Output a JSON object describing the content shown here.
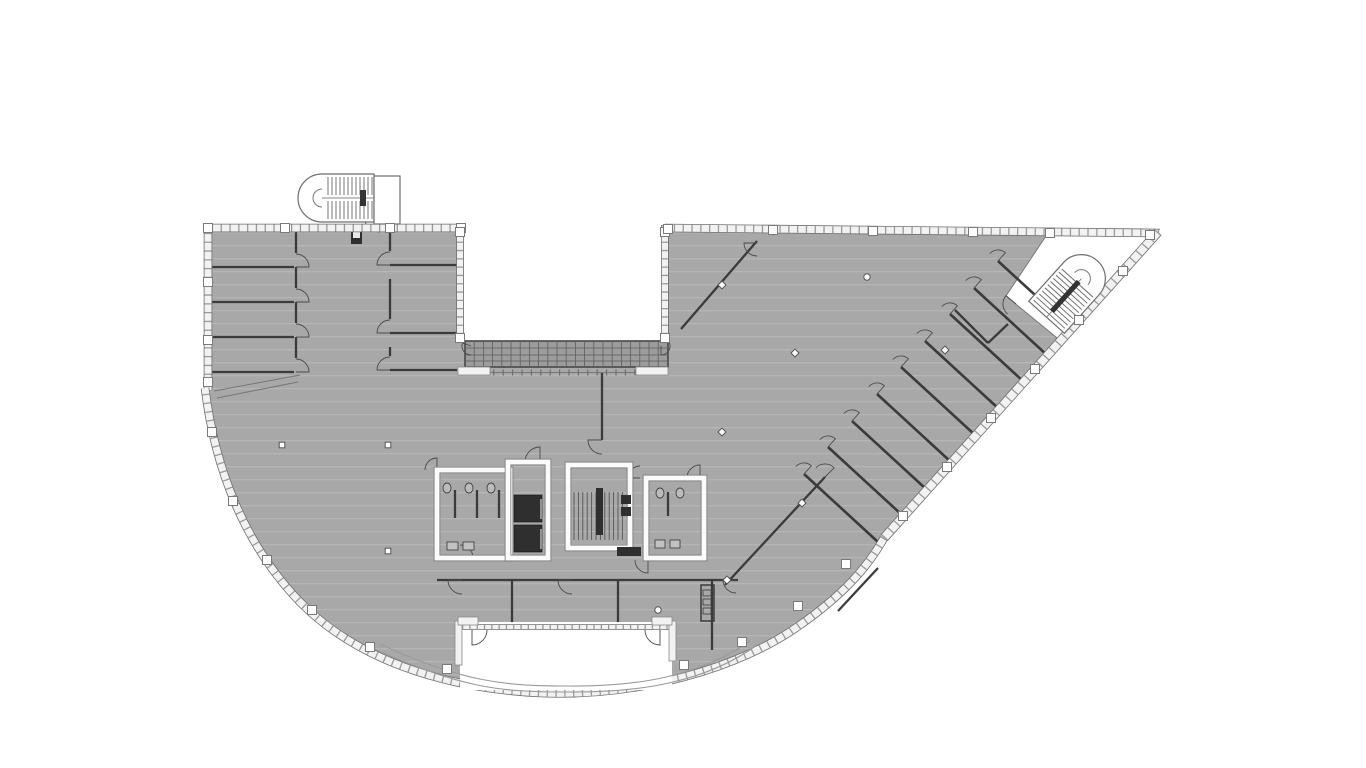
{
  "meta": {
    "description": "Grayscale architectural floor plan: fan-shaped office floor with curved south facade, rectangular north-west wing, diagonal north-east wing, two external U-stairs, central core with elevators, dog-leg stair and toilet blocks, glazed bridge over a void, terrace notch at the south facade",
    "canvas": {
      "width": 1366,
      "height": 768
    }
  },
  "palette": {
    "bg": "#ffffff",
    "floor": "#a8a8a8",
    "floor_stripe": "#bdbdbd",
    "wall_dark": "#3b3b3b",
    "outline": "#5a5a5a",
    "band_fill": "#f2f2f2",
    "band_edge": "#6e6e6e",
    "band_rung": "#9a9a9a",
    "bridge_fill": "#9c9c9c",
    "bridge_grid": "#5e5e5e",
    "elevator_dark": "#2f2f2f",
    "white": "#ffffff",
    "thin_line": "#777777"
  },
  "plan": {
    "plate": {
      "name": "floor-plate",
      "d": "M 205 225 L 463 225 L 463 341 L 668 341 L 668 225 L 1158 231 L 884 538 C 866 570 840 597 800 625 C 740 668 640 697 540 693 C 440 688 355 658 300 602 C 245 545 215 470 205 388 Z"
    },
    "pocket": {
      "name": "stair-pocket",
      "d": "M 1048 233 L 1148 233 L 1150 242 L 1062 342 L 1006 296 Z"
    },
    "notch": {
      "name": "terrace-notch",
      "d": "M 460 622 L 672 622 L 672 690 L 460 690 Z"
    },
    "canopy": [
      {
        "name": "canopy-arc-outer",
        "d": "M 372 648 C 460 688 500 692 566 692 C 640 693 706 682 757 645"
      },
      {
        "name": "canopy-arc-inner",
        "d": "M 380 644 C 462 682 505 686 566 686 C 638 687 700 676 750 641"
      }
    ],
    "bands": [
      {
        "name": "facade-top-left-wing",
        "d": "M 203 228 L 465 228",
        "w": 7,
        "gap": 7.5
      },
      {
        "name": "facade-left",
        "d": "M 208 224 L 208 390",
        "w": 7,
        "gap": 7.5
      },
      {
        "name": "facade-void-left",
        "d": "M 460 225 L 460 341",
        "w": 6,
        "gap": 7
      },
      {
        "name": "facade-void-right",
        "d": "M 665 225 L 665 341",
        "w": 6,
        "gap": 7
      },
      {
        "name": "facade-top-right-wing",
        "d": "M 665 228 L 1160 233",
        "w": 7,
        "gap": 7.5
      },
      {
        "name": "facade-diagonal",
        "d": "M 1158 232 L 884 538",
        "w": 8,
        "gap": 8
      },
      {
        "name": "facade-curve",
        "d": "M 884 538 C 866 570 840 597 800 625 C 740 668 640 697 540 693 C 440 688 355 658 300 602 C 245 545 215 470 205 388",
        "w": 7,
        "gap": 7.5
      }
    ],
    "notch_band": {
      "name": "terrace-glazing",
      "d": "M 462 627 L 670 627",
      "w": 4,
      "gap": 6
    },
    "notch_rects": [
      [
        455,
        621,
        7,
        44
      ],
      [
        669,
        621,
        7,
        40
      ],
      [
        458,
        617,
        20,
        8
      ],
      [
        652,
        617,
        20,
        8
      ]
    ],
    "notch_doors": [
      {
        "x": 472,
        "y": 630,
        "r": 15,
        "f": 0,
        "t": 90
      },
      {
        "x": 660,
        "y": 630,
        "r": 15,
        "f": 180,
        "t": 90
      }
    ],
    "bridge": {
      "name": "glazed-bridge",
      "x": 465,
      "y": 341,
      "w": 203,
      "h": 26,
      "vstep": 9.2,
      "hlines": [
        348,
        355,
        361
      ],
      "rail_y": 372.5,
      "sills": [
        [
          458,
          367,
          32,
          8
        ],
        [
          636,
          367,
          32,
          8
        ]
      ],
      "hooks": [
        {
          "x": 471,
          "y": 346,
          "r": 9,
          "f": 90,
          "t": 200
        },
        {
          "x": 661,
          "y": 346,
          "r": 9,
          "f": -20,
          "t": 90
        }
      ]
    },
    "walls": [
      [
        208,
        267,
        294,
        267
      ],
      [
        208,
        302,
        294,
        302
      ],
      [
        208,
        337,
        294,
        337
      ],
      [
        208,
        372,
        294,
        372
      ],
      [
        296,
        232,
        296,
        253
      ],
      [
        296,
        267,
        296,
        288
      ],
      [
        296,
        302,
        296,
        323
      ],
      [
        296,
        337,
        296,
        358
      ],
      [
        390,
        265,
        462,
        265
      ],
      [
        390,
        333,
        462,
        333
      ],
      [
        390,
        370,
        457,
        370
      ],
      [
        390,
        232,
        390,
        251
      ],
      [
        390,
        279,
        390,
        319
      ],
      [
        390,
        347,
        390,
        356
      ],
      [
        602,
        373,
        602,
        440
      ],
      [
        437,
        580,
        738,
        580
      ],
      [
        512,
        580,
        512,
        624
      ],
      [
        618,
        580,
        618,
        624
      ],
      [
        712,
        580,
        712,
        650
      ],
      [
        757,
        241,
        681,
        329
      ],
      [
        825,
        477,
        725,
        585
      ],
      [
        878,
        568,
        838,
        611
      ],
      [
        955,
        310,
        988,
        343
      ],
      [
        988,
        343,
        1008,
        324
      ],
      [
        455,
        490,
        455,
        518
      ],
      [
        477,
        490,
        477,
        518
      ],
      [
        499,
        490,
        499,
        518
      ],
      [
        668,
        492,
        668,
        516
      ]
    ],
    "ramp_lines": [
      [
        214,
        391,
        300,
        375
      ],
      [
        217,
        398,
        298,
        382
      ]
    ],
    "office_walls": [
      [
        998,
        261,
        1072,
        329
      ],
      [
        974,
        288,
        1048,
        356
      ],
      [
        950,
        314,
        1024,
        382
      ],
      [
        925,
        341,
        999,
        409
      ],
      [
        901,
        367,
        975,
        435
      ],
      [
        877,
        394,
        951,
        462
      ],
      [
        852,
        421,
        926,
        489
      ],
      [
        828,
        447,
        902,
        515
      ],
      [
        804,
        474,
        878,
        542
      ]
    ],
    "office_door": {
      "r": 11,
      "f": -138,
      "t": -48
    },
    "doors": [
      {
        "x": 296,
        "y": 267,
        "r": 13,
        "f": -90,
        "t": 0
      },
      {
        "x": 296,
        "y": 302,
        "r": 13,
        "f": -90,
        "t": 0
      },
      {
        "x": 296,
        "y": 337,
        "r": 13,
        "f": -90,
        "t": 0
      },
      {
        "x": 296,
        "y": 372,
        "r": 13,
        "f": -90,
        "t": 0
      },
      {
        "x": 390,
        "y": 265,
        "r": 13,
        "f": -90,
        "t": -180
      },
      {
        "x": 390,
        "y": 333,
        "r": 13,
        "f": -90,
        "t": -180
      },
      {
        "x": 390,
        "y": 370,
        "r": 13,
        "f": -90,
        "t": -180
      },
      {
        "x": 602,
        "y": 440,
        "r": 14,
        "f": 90,
        "t": 180
      },
      {
        "x": 462,
        "y": 580,
        "r": 14,
        "f": 90,
        "t": 180
      },
      {
        "x": 572,
        "y": 580,
        "r": 14,
        "f": 90,
        "t": 180
      },
      {
        "x": 736,
        "y": 580,
        "r": 13,
        "f": 90,
        "t": 180
      },
      {
        "x": 757,
        "y": 243,
        "r": 13,
        "f": 90,
        "t": 180
      },
      {
        "x": 825,
        "y": 477,
        "r": 13,
        "f": -135,
        "t": -45
      },
      {
        "x": 540,
        "y": 462,
        "r": 15,
        "f": 180,
        "t": 270
      },
      {
        "x": 460,
        "y": 558,
        "r": 13,
        "f": -90,
        "t": 0
      },
      {
        "x": 648,
        "y": 560,
        "r": 13,
        "f": 180,
        "t": 90
      },
      {
        "x": 700,
        "y": 478,
        "r": 13,
        "f": 180,
        "t": 270
      },
      {
        "x": 640,
        "y": 478,
        "r": 12,
        "f": -90,
        "t": -180
      },
      {
        "x": 437,
        "y": 470,
        "r": 12,
        "f": 180,
        "t": 270
      },
      {
        "x": 1016,
        "y": 304,
        "r": 13,
        "f": 130,
        "t": 220
      },
      {
        "x": 380,
        "y": 216,
        "r": 16,
        "f": 90,
        "t": 180
      }
    ],
    "wrooms": [
      {
        "name": "toilet-room-left",
        "r": [
          437,
          470,
          73,
          88
        ]
      },
      {
        "name": "elevator-shaft",
        "r": [
          508,
          462,
          40,
          96
        ]
      },
      {
        "name": "stair-core-room",
        "r": [
          568,
          465,
          62,
          83
        ]
      },
      {
        "name": "toilet-room-right",
        "r": [
          646,
          478,
          58,
          80
        ]
      }
    ],
    "elevators": [
      [
        514,
        495,
        28,
        27
      ],
      [
        514,
        525,
        28,
        27
      ]
    ],
    "elevator_doors": [
      [
        541,
        499,
        541,
        519
      ],
      [
        541,
        529,
        541,
        549
      ]
    ],
    "dark_rects": [
      [
        621,
        495,
        10,
        9
      ],
      [
        621,
        507,
        10,
        9
      ],
      [
        617,
        547,
        24,
        9
      ],
      [
        596,
        488,
        7,
        47
      ],
      [
        351,
        230,
        11,
        14
      ]
    ],
    "white_inner_rects": [
      [
        353,
        232,
        7,
        6
      ]
    ],
    "shaft": {
      "r": [
        701,
        585,
        13,
        36
      ],
      "cells": [
        [
          703,
          590,
          8,
          6
        ],
        [
          703,
          599,
          8,
          6
        ],
        [
          703,
          608,
          8,
          6
        ]
      ]
    },
    "fixtures": {
      "wc": [
        [
          447,
          488,
          4,
          5
        ],
        [
          469,
          488,
          4,
          5
        ],
        [
          491,
          488,
          4,
          5
        ],
        [
          660,
          493,
          4,
          5
        ],
        [
          680,
          493,
          4,
          5
        ]
      ],
      "sinks": [
        [
          447,
          542,
          11,
          8
        ],
        [
          463,
          542,
          11,
          8
        ],
        [
          655,
          540,
          10,
          8
        ],
        [
          670,
          540,
          10,
          8
        ]
      ]
    },
    "core_treads": {
      "x0": 574,
      "x1": 624,
      "step": 4.4,
      "bands": [
        [
          492,
          540
        ]
      ]
    },
    "stairs": [
      {
        "name": "external-stair-northwest",
        "transform": "translate(336,198)",
        "a": 38,
        "b": 14,
        "hw": 24,
        "tread_x0": -8,
        "tread_x1": 36,
        "tread_step": 4,
        "tread_bands": [
          [
            -21,
            -3
          ],
          [
            3,
            21
          ]
        ],
        "bars": [
          [
            24,
            -8,
            6,
            16
          ]
        ]
      },
      {
        "name": "external-stair-northeast",
        "transform": "translate(1072,289) rotate(132)",
        "a": 38,
        "b": 14,
        "hw": 24,
        "tread_x0": -8,
        "tread_x1": 36,
        "tread_step": 4.2,
        "tread_bands": [
          [
            -21,
            21
          ]
        ],
        "bars": [
          [
            -10,
            -2.6,
            40,
            5.2
          ]
        ]
      }
    ],
    "lobby": {
      "name": "stair-lobby-northwest",
      "r": [
        374,
        176,
        26,
        48
      ]
    },
    "piers": [
      [
        208,
        228
      ],
      [
        285,
        228
      ],
      [
        390,
        228
      ],
      [
        461,
        228
      ],
      [
        460,
        232
      ],
      [
        665,
        232
      ],
      [
        460,
        338
      ],
      [
        665,
        338
      ],
      [
        668,
        229
      ],
      [
        773,
        230
      ],
      [
        873,
        231
      ],
      [
        973,
        232
      ],
      [
        1050,
        233
      ],
      [
        1150,
        235
      ],
      [
        208,
        282
      ],
      [
        208,
        340
      ],
      [
        208,
        382
      ],
      [
        212,
        432
      ],
      [
        233,
        501
      ],
      [
        267,
        560
      ],
      [
        312,
        610
      ],
      [
        370,
        647
      ],
      [
        447,
        669
      ],
      [
        684,
        665
      ],
      [
        742,
        642
      ],
      [
        798,
        606
      ],
      [
        846,
        564
      ],
      [
        1123,
        271
      ],
      [
        1079,
        320
      ],
      [
        1035,
        369
      ],
      [
        991,
        418
      ],
      [
        947,
        467
      ],
      [
        903,
        516
      ]
    ],
    "col_squares": [
      [
        282,
        445
      ],
      [
        388,
        445
      ],
      [
        388,
        551
      ]
    ],
    "col_diamonds": [
      [
        722,
        285
      ],
      [
        795,
        353
      ],
      [
        722,
        432
      ],
      [
        727,
        580
      ],
      [
        945,
        350
      ],
      [
        802,
        503
      ]
    ],
    "col_circles": [
      [
        867,
        277
      ],
      [
        658,
        610
      ]
    ]
  }
}
